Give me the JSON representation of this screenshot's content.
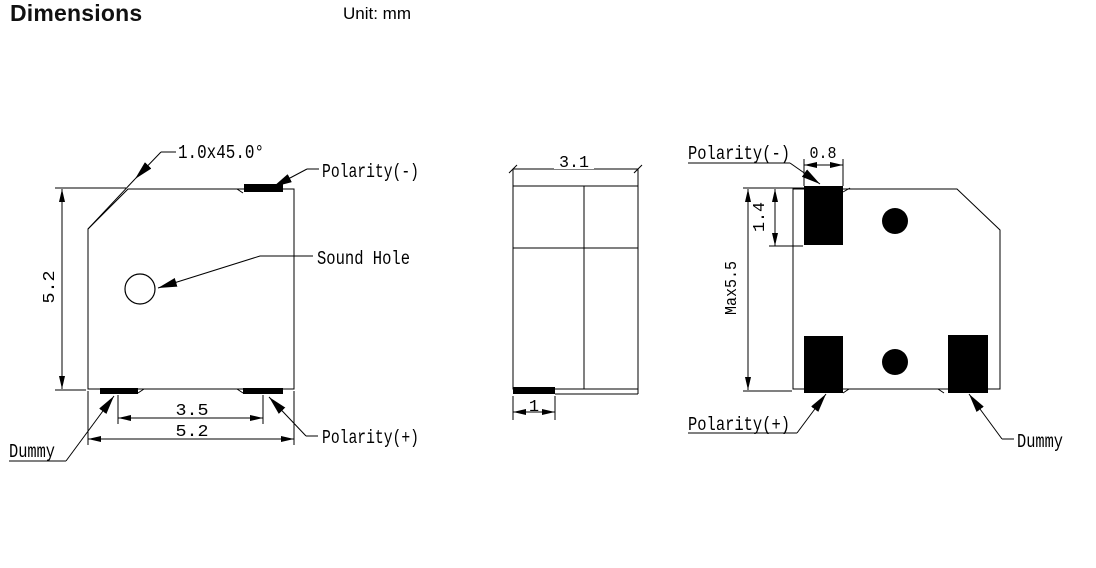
{
  "header": {
    "title": "Dimensions",
    "unit_label": "Unit: mm"
  },
  "colors": {
    "ink": "#000000",
    "background": "#ffffff"
  },
  "views": {
    "top_view": {
      "labels": {
        "chamfer": "1.0x45.0°",
        "polarity_neg": "Polarity(-)",
        "sound_hole": "Sound Hole",
        "dummy": "Dummy",
        "polarity_pos": "Polarity(+)"
      },
      "dims": {
        "height": "5.2",
        "pad_pitch": "3.5",
        "width": "5.2"
      }
    },
    "side_view": {
      "dims": {
        "width": "3.1",
        "pad_width": "1"
      }
    },
    "bottom_view": {
      "labels": {
        "polarity_neg": "Polarity(-)",
        "polarity_pos": "Polarity(+)",
        "dummy": "Dummy"
      },
      "dims": {
        "pad_width": "0.8",
        "pad_height": "1.4",
        "height": "Max5.5"
      }
    }
  }
}
